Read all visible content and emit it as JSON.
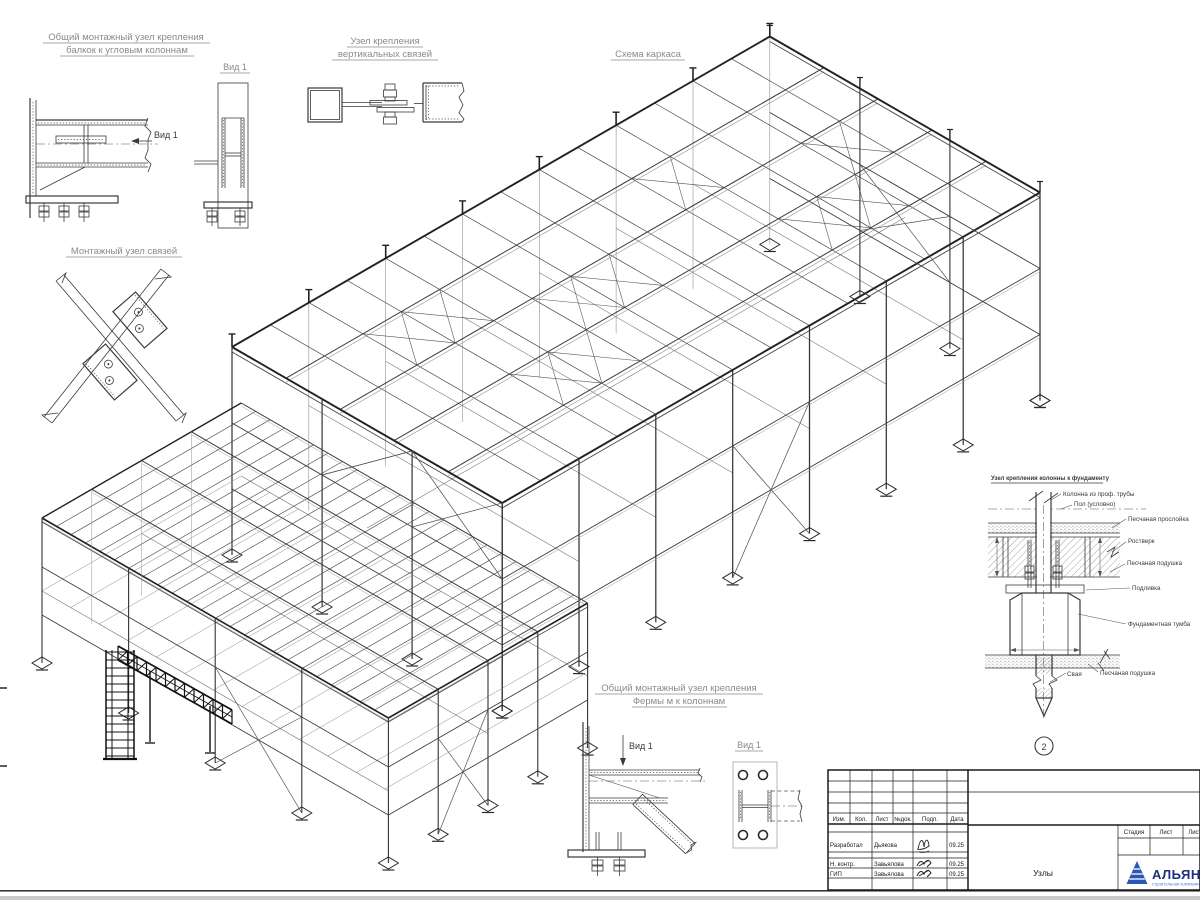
{
  "labels": {
    "d1_t1": "Общий монтажный узел крепления",
    "d1_t2": "балкок к угловым колоннам",
    "d1_view": "Вид 1",
    "d1_callout": "Вид 1",
    "d2_t1": "Узел крепления",
    "d2_t2": "вертикальных связей",
    "scheme": "Схема каркаса",
    "d3_t": "Монтажный узел связей",
    "d5_t1": "Общий монтажный узел крепления",
    "d5_t2": "Фермы м к колоннам",
    "d5_view": "Вид 1",
    "d5_callout": "Вид 1"
  },
  "foundation": {
    "title": "Узел крепления колонны к фундаменту",
    "lbl_column": "Колонна из проф. трубы",
    "lbl_floor": "Пол (условно)",
    "lbl_sand_layer": "Песчаная прослойка",
    "lbl_rostverk": "Ростверк",
    "lbl_cushion": "Песчаная подушка",
    "lbl_grout": "Подливка",
    "lbl_pedestal": "Фундаментная тумба",
    "lbl_pile": "Свая",
    "lbl_cushion2": "Песчаная подушка",
    "marker": "2"
  },
  "tb": {
    "rev": [
      "Изм.",
      "Кол.",
      "Лист",
      "№док.",
      "Подп.",
      "Дата"
    ],
    "rows": [
      {
        "role": "Разработал",
        "name": "Дьякова",
        "date": "09.25"
      },
      {
        "role": "Н. контр.",
        "name": "Завьялова",
        "date": "09.25"
      },
      {
        "role": "ГИП",
        "name": "Завьялова",
        "date": "09.25"
      }
    ],
    "stage": [
      "Стадия",
      "Лист",
      "Листов"
    ],
    "doc_name": "Узлы",
    "company": "АЛЬЯНС",
    "company_sub": "строительная компания",
    "logo_color": "#2a56b8"
  }
}
